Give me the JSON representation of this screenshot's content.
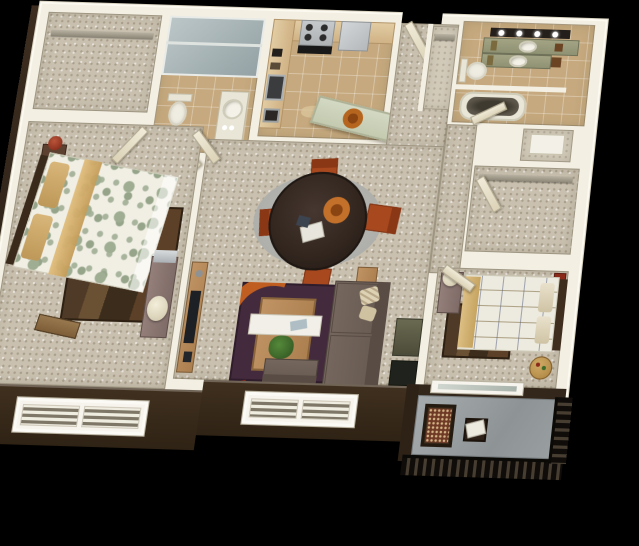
{
  "meta": {
    "description": "3D rendered top-down floor plan of a two-bedroom, two-bathroom apartment with balcony",
    "view": "aerial perspective dollhouse render",
    "background_color": "#000000"
  },
  "palette": {
    "exterior_wall": "#35281c",
    "wall_top": "#f3efe3",
    "interior_wall": "#ddd5bd",
    "carpet": "#c9c0af",
    "tile": "#c6a97e",
    "cabinet_wood": "#d2b088",
    "stainless": "#b9bdbf",
    "island_top": "#ccd3bd",
    "vanity_counter": "#98a07c",
    "dining_table": "#37291f",
    "dining_chair": "#a8481f",
    "dining_rug": "#b4b5b1",
    "living_rug_plum": "#432b3d",
    "living_rug_orange": "#c05d20",
    "sofa": "#6e6057",
    "bed1_accent_gold": "#d3ad68",
    "bed1_pattern_sage": "#9fae92",
    "bed2_throw_tan": "#d2b176",
    "area_rug_brown": "#4e3a26",
    "balcony_concrete": "#9aa0a3",
    "railing": "#1a140e",
    "accent_red": "#93301c"
  },
  "rooms": {
    "walk_in_closet_1": {
      "label": "Walk-in closet",
      "items": [
        "closet shelf and rod"
      ]
    },
    "hall_bath": {
      "label": "Hall bathroom",
      "items": [
        "glass shower stall",
        "toilet",
        "pedestal sink",
        "door"
      ]
    },
    "kitchen": {
      "label": "Kitchen",
      "items": [
        "L-shaped counters",
        "range with burners",
        "refrigerator",
        "sink",
        "island with round tray"
      ]
    },
    "entry": {
      "label": "Entry hall",
      "items": [
        "open entry door",
        "coat closet with shelf"
      ]
    },
    "master_bath": {
      "label": "Master bathroom",
      "items": [
        "double vanity with lighted mirror bar",
        "two round sinks",
        "toilet",
        "garden tub"
      ]
    },
    "linen_closet": {
      "label": "Linen closet",
      "items": [
        "white shelving"
      ]
    },
    "walk_in_closet_2": {
      "label": "Walk-in closet",
      "items": [
        "closet shelf and rod",
        "door"
      ]
    },
    "bedroom_1": {
      "label": "Bedroom 1",
      "items": [
        "bed with sage circle-pattern duvet and gold runner",
        "dark headboard",
        "nightstand with red lamp",
        "brown area rug",
        "foot bench",
        "dresser with mirror and cream lamp",
        "double window"
      ]
    },
    "dining": {
      "label": "Dining area",
      "items": [
        "round espresso table",
        "orange centerpiece tray",
        "four rust dining chairs",
        "round gray rug"
      ]
    },
    "living": {
      "label": "Living room",
      "items": [
        "plum rug with orange swirls",
        "wood coffee table with white runner and plant",
        "brown sofa with cream pillows",
        "armless chair",
        "media console with TV",
        "end table",
        "window"
      ]
    },
    "bedroom_2": {
      "label": "Bedroom 2",
      "items": [
        "bed with geometric-pattern duvet",
        "tan pillows and throw",
        "dark area rug",
        "dresser with cream lamp",
        "red cabinet",
        "drum side table",
        "sliding glass door"
      ]
    },
    "balcony": {
      "label": "Balcony",
      "items": [
        "concrete floor",
        "dark wood chair with patterned cushion",
        "side table with magazine",
        "metal railing"
      ]
    }
  }
}
